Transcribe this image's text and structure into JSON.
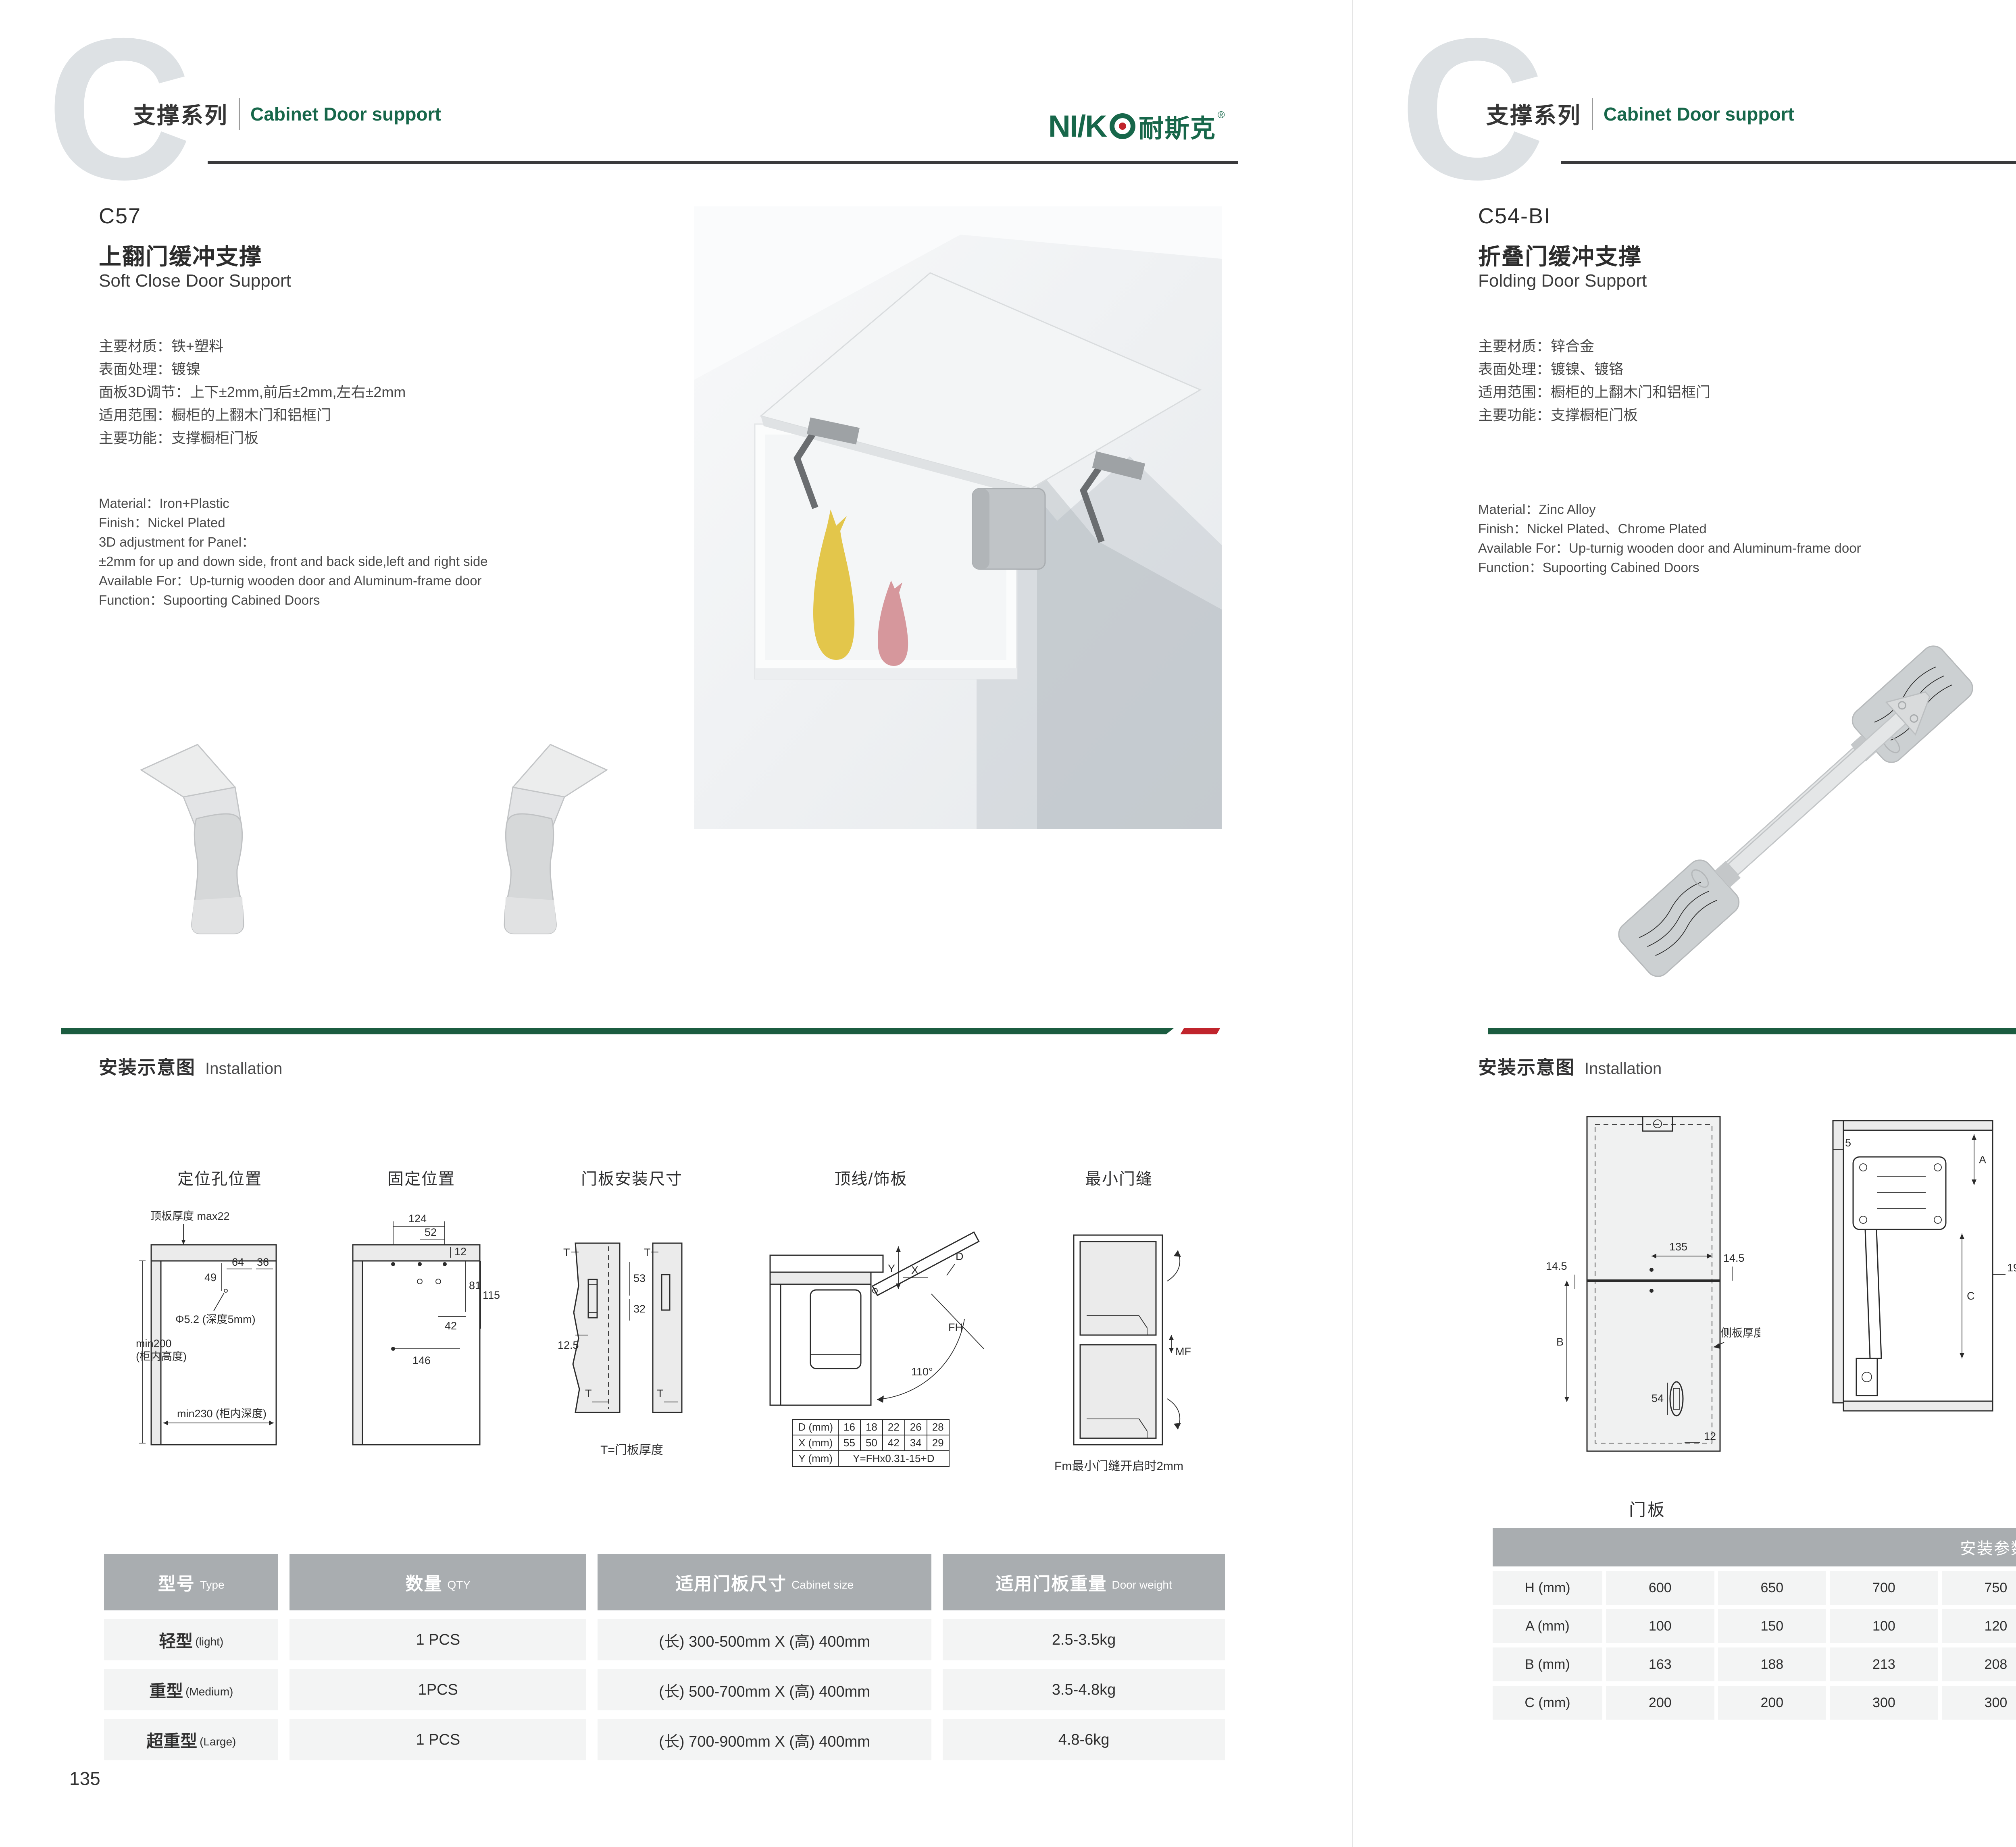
{
  "brand": {
    "logo_latin": "NI/K",
    "logo_cn": "耐斯克",
    "logo_reg": "®"
  },
  "left": {
    "header": {
      "watermark": "C",
      "series_cn": "支撑系列",
      "series_en": "Cabinet Door support"
    },
    "product": {
      "code": "C57",
      "title_cn": "上翻门缓冲支撑",
      "title_en": "Soft Close Door Support",
      "specs_cn": [
        "主要材质：铁+塑料",
        "表面处理：镀镍",
        "面板3D调节：上下±2mm,前后±2mm,左右±2mm",
        "适用范围：橱柜的上翻木门和铝框门",
        "主要功能：支撑橱柜门板"
      ],
      "specs_en": [
        "Material：Iron+Plastic",
        "Finish：Nickel Plated",
        "3D adjustment for Panel：",
        "±2mm for up and down side, front and back side,left and right side",
        "Available For：Up-turnig wooden door and Aluminum-frame door",
        "Function：Supoorting Cabined Doors"
      ]
    },
    "installation": {
      "heading_cn": "安装示意图",
      "heading_en": "Installation",
      "d1": {
        "title": "定位孔位置",
        "top_label": "顶板厚度 max22",
        "dim49": "49",
        "dim64": "64",
        "dim36": "36",
        "hole": "Φ5.2 (深度5mm)",
        "left1": "min200",
        "left2": "(柜内高度)",
        "depth": "min230 (柜内深度)"
      },
      "d2": {
        "title": "固定位置",
        "d124": "124",
        "d52": "52",
        "d12": "12",
        "d81": "81",
        "d115": "115",
        "d42": "42",
        "d146": "146"
      },
      "d3": {
        "title": "门板安装尺寸",
        "t1": "T",
        "d53": "53",
        "d32": "32",
        "d125": "12.5",
        "t2": "T",
        "t3": "T",
        "t4": "T",
        "caption": "T=门板厚度"
      },
      "d4": {
        "title": "顶线/饰板",
        "y": "Y",
        "x": "X",
        "d": "D",
        "fh": "FH",
        "angle": "110°",
        "tbl": {
          "r1": [
            "D (mm)",
            "16",
            "18",
            "22",
            "26",
            "28"
          ],
          "r2": [
            "X (mm)",
            "55",
            "50",
            "42",
            "34",
            "29"
          ],
          "r3l": "Y (mm)",
          "r3v": "Y=FHx0.31-15+D"
        }
      },
      "d5": {
        "title": "最小门缝",
        "mf": "MF",
        "caption": "Fm最小门缝开启时2mm"
      }
    },
    "table": {
      "headers": [
        {
          "cn": "型号",
          "en": "Type"
        },
        {
          "cn": "数量",
          "en": "QTY"
        },
        {
          "cn": "适用门板尺寸",
          "en": "Cabinet size"
        },
        {
          "cn": "适用门板重量",
          "en": "Door weight"
        }
      ],
      "rows": [
        {
          "cn": "轻型",
          "en": "(light)",
          "qty": "1 PCS",
          "size": "(长) 300-500mm X (高) 400mm",
          "wt": "2.5-3.5kg"
        },
        {
          "cn": "重型",
          "en": "(Medium)",
          "qty": "1PCS",
          "size": "(长) 500-700mm X (高) 400mm",
          "wt": "3.5-4.8kg"
        },
        {
          "cn": "超重型",
          "en": "(Large)",
          "qty": "1 PCS",
          "size": "(长) 700-900mm X (高) 400mm",
          "wt": "4.8-6kg"
        }
      ]
    },
    "page_number": "135"
  },
  "right": {
    "header": {
      "watermark": "C",
      "series_cn": "支撑系列",
      "series_en": "Cabinet Door support"
    },
    "product": {
      "code": "C54-BI",
      "title_cn": "折叠门缓冲支撑",
      "title_en": "Folding Door Support",
      "specs_cn": [
        "主要材质：锌合金",
        "表面处理：镀镍、镀铬",
        "适用范围：橱柜的上翻木门和铝框门",
        "主要功能：支撑橱柜门板"
      ],
      "specs_en": [
        "Material：Zinc Alloy",
        "Finish：Nickel Plated、Chrome Plated",
        "Available For：Up-turnig wooden door and Aluminum-frame door",
        "Function：Supoorting Cabined Doors"
      ]
    },
    "installation": {
      "heading_cn": "安装示意图",
      "heading_en": "Installation",
      "rd1": {
        "d135": "135",
        "d145a": "14.5",
        "d145b": "14.5",
        "b": "B",
        "d54": "54",
        "d12": "12",
        "side": "侧板厚度",
        "caption": "门板"
      },
      "rd2": {
        "d5": "5",
        "a": "A",
        "c": "C",
        "d19": "19"
      },
      "rd3": {
        "d193": "193",
        "d102": "102",
        "d23": "23",
        "h": "H",
        "d50": "50"
      },
      "rd4": {
        "d24": "24",
        "d12": "12"
      }
    },
    "reference": {
      "title_cn": "安装参数",
      "title_en": "Reference Data",
      "rows": [
        {
          "label": "H (mm)",
          "values": [
            "600",
            "650",
            "700",
            "750",
            "800",
            "850",
            "900",
            "950",
            "1000"
          ]
        },
        {
          "label": "A (mm)",
          "values": [
            "100",
            "150",
            "100",
            "120",
            "200",
            "250",
            "200",
            "250",
            "250"
          ]
        },
        {
          "label": "B (mm)",
          "values": [
            "163",
            "188",
            "213",
            "208",
            "263",
            "288",
            "263",
            "288",
            "313"
          ]
        },
        {
          "label": "C (mm)",
          "values": [
            "200",
            "200",
            "300",
            "300",
            "300",
            "300",
            "350",
            "350",
            "400"
          ]
        }
      ]
    },
    "page_number": "136"
  },
  "colors": {
    "green": "#17674a",
    "bar_green": "#1b5c40",
    "red": "#c0242c",
    "header_gray": "#a9adb0",
    "row_gray": "#f3f4f4"
  }
}
